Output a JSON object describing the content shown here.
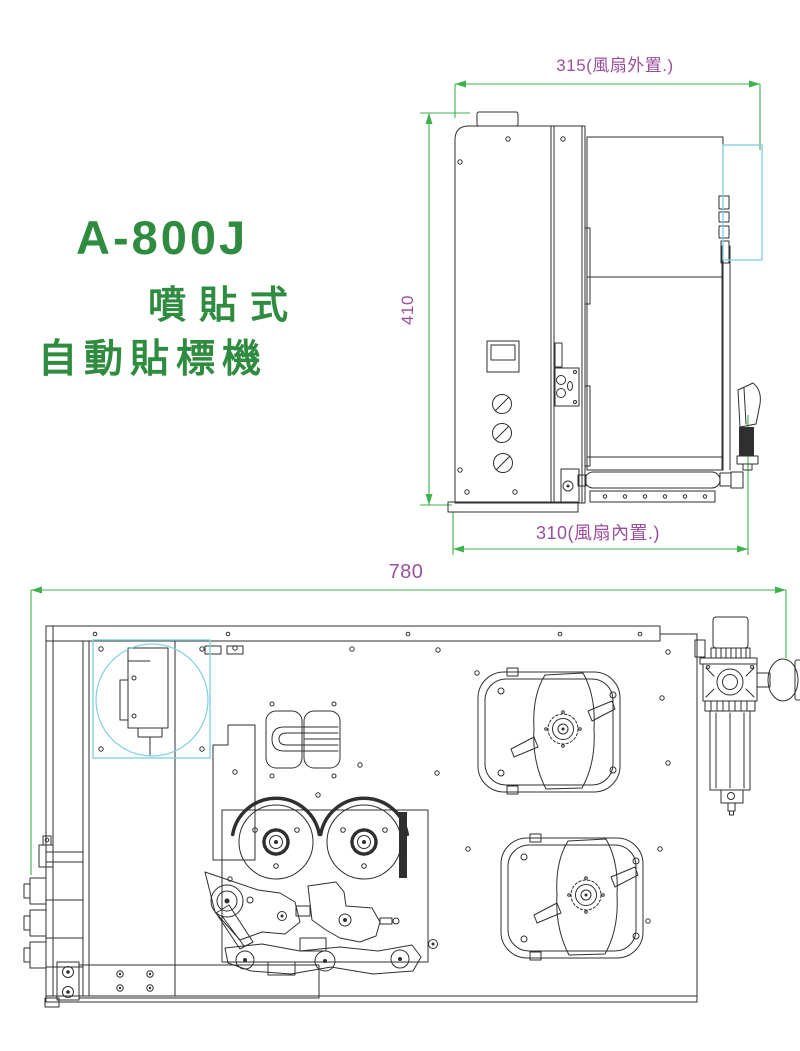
{
  "title": {
    "model": "A-800J",
    "subtitle_line1": "噴貼式",
    "subtitle_line2": "自動貼標機"
  },
  "side_view": {
    "dim_top": "315(風扇外置.)",
    "dim_left": "410",
    "dim_bottom": "310(風扇內置.)"
  },
  "top_view": {
    "dim_top": "780"
  },
  "colors": {
    "title_green": "#2e8b3f",
    "dimension_green": "#3db14c",
    "dimension_purple": "#9b4f9d",
    "highlight_cyan": "#85cfe2",
    "line_art": "#2f2f2f"
  }
}
